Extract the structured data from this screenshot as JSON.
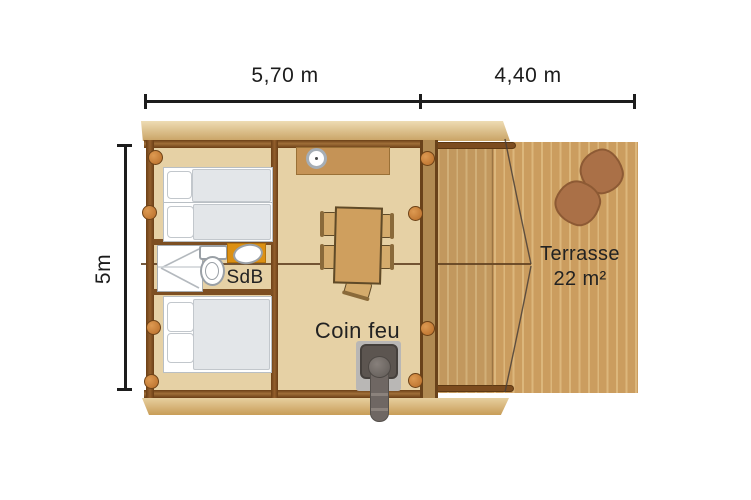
{
  "plan": {
    "type": "floor-plan",
    "dimensions": {
      "cabin_width": "5,70 m",
      "terrace_width": "4,40 m",
      "depth": "5m"
    },
    "rooms": {
      "bathroom_label": "SdB",
      "fire_corner_label": "Coin feu",
      "terrace_name": "Terrasse",
      "terrace_area": "22 m²"
    },
    "objects": [
      "twin-beds",
      "double-bed",
      "shower",
      "toilet",
      "washbasin",
      "kitchen-counter",
      "burner",
      "dining-table",
      "chairs",
      "wood-stove",
      "stove-pipe",
      "terrace-poufs"
    ],
    "colors": {
      "platform": "#d9b97c",
      "decking": "#cb9d5f",
      "decking_stripe": "#dcb77c",
      "floor": "#e6d1a5",
      "wall": "#7d4f22",
      "knob": "#c87a33",
      "counter_orange": "#dc9013",
      "table": "#cf9f5e",
      "stove": "#5c5550",
      "pouf": "#aa7047",
      "text": "#1f1f1f"
    }
  }
}
